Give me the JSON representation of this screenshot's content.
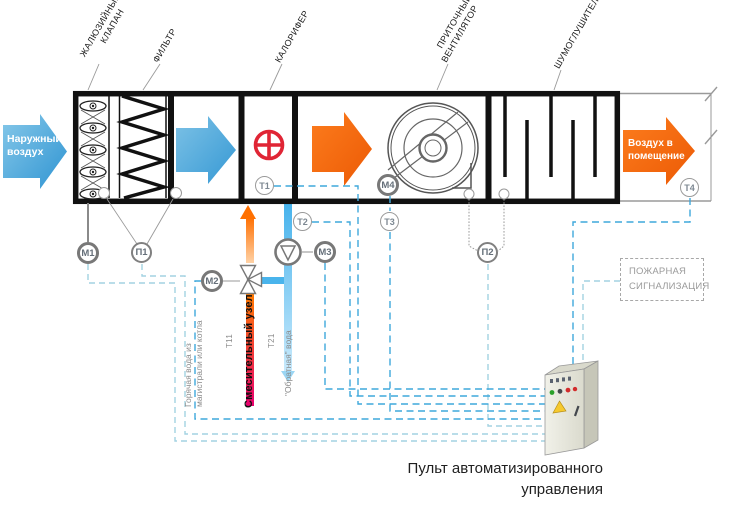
{
  "inlet": {
    "line1": "Наружный",
    "line2": "воздух"
  },
  "outlet": {
    "line1": "Воздух в",
    "line2": "помещение"
  },
  "components": {
    "louver_line1": "ЖАЛЮЗИЙНЫЙ",
    "louver_line2": "КЛАПАН",
    "filter": "ФИЛЬТР",
    "heater": "КАЛОРИФЕР",
    "fan_line1": "ПРИТОЧНЫЙ",
    "fan_line2": "ВЕНТИЛЯТОР",
    "silencer": "ШУМОГЛУШИТЕЛЬ"
  },
  "sensors": {
    "m1": "М1",
    "p1": "П1",
    "m2": "М2",
    "m3": "М3",
    "m4": "М4",
    "p2": "П2",
    "t1": "Т1",
    "t2": "Т2",
    "t3": "Т3",
    "t4": "Т4"
  },
  "mixing_unit": {
    "title": "Смесительный узел",
    "hot_line1": "Горячая вода из",
    "hot_line2": "магистрали или котла",
    "supply_tag": "Т11",
    "return_tag": "Т21",
    "return_label": "\"Обратная\" вода"
  },
  "fire_alarm": {
    "line1": "ПОЖАРНАЯ",
    "line2": "СИГНАЛИЗАЦИЯ"
  },
  "control_panel": {
    "caption_line1": "Пульт автоматизированного",
    "caption_line2": "управления"
  },
  "colors": {
    "arrow_blue": "#2f94d2",
    "arrow_orange": "#f3650c",
    "heater_red": "#e02535",
    "hot_supply_top": "#ff7a00",
    "hot_supply_bottom": "#e8006e",
    "return_water": "#45b2ec",
    "signal_dashed": "#3fa8dc",
    "signal_dashed_pale": "#a3d2e2"
  }
}
